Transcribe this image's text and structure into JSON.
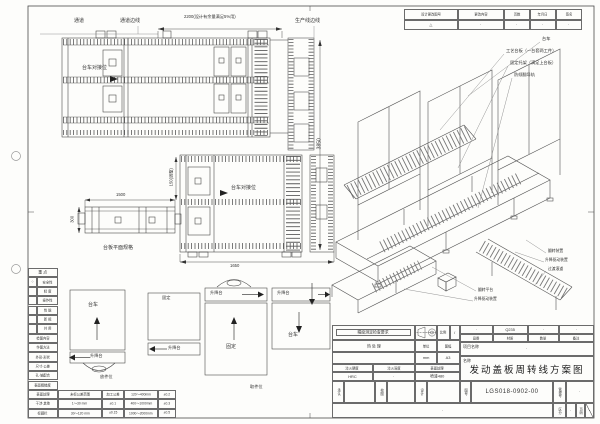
{
  "palette": {
    "ink": "#3a3a3a",
    "paper": "#fdfdfb",
    "grid": "#6b6b6b"
  },
  "revision": {
    "headers": [
      "设计更改图号",
      "更改内容",
      "页数",
      "年月日",
      "签名"
    ],
    "row": [
      "△",
      "·",
      "·",
      "·",
      "·"
    ]
  },
  "plan_top": {
    "passage": "通道",
    "passage_edge": "通道边线",
    "prod_edge": "生产线边线",
    "dock": "台车对接位",
    "dim_2200": "2200(设计有余量满足5%用)",
    "dim_3850": "3850"
  },
  "plan_mid": {
    "dock": "台车对接位",
    "dim_1650": "1650",
    "dim_150": "150(调整)"
  },
  "side_view": {
    "dim_1500": "1500",
    "dim_300": "300",
    "caption": "台板平面规格"
  },
  "stations": {
    "a_box": "台车",
    "a_strip": "升降台",
    "a_caption": "放件位",
    "b_box": "固定",
    "b_strip": "升降台",
    "c_box": "固定",
    "c_strip": "升降台",
    "d_box": "台车",
    "d_strip": "升降台",
    "d_caption": "取件位"
  },
  "checklist": {
    "section1": "重 点",
    "rows1": [
      {
        "mark": "○",
        "label": "安全性"
      },
      {
        "mark": "",
        "label": "精 度"
      },
      {
        "mark": "",
        "label": "操作性"
      },
      {
        "mark": "",
        "label": "性 能"
      },
      {
        "mark": "",
        "label": "新 规"
      },
      {
        "mark": "",
        "label": "共 用"
      }
    ],
    "section2": "检图内容",
    "rows2": [
      "作图方法",
      "外形·形状",
      "尺寸·公差",
      "孔·轴配合",
      "表面粗糙度",
      "表面处理",
      "干涉·其他",
      "标题栏"
    ]
  },
  "tolerance": {
    "rows": [
      [
        "未标公差范围",
        "加工公差",
        "120～400mm",
        "±0.2"
      ],
      [
        "1～30 mm",
        "±0.1",
        "400～1000mm",
        "±0.3"
      ],
      [
        "30～120 mm",
        "±0.15",
        "1000～2000mm",
        "±0.5"
      ]
    ]
  },
  "iso": {
    "callout_cart": "台车",
    "callout_pallet": "工艺台板（一台套两工件）",
    "callout_bracket": "固定托架（满足上台板）",
    "callout_rail": "防倾翻导轨",
    "callout_flip": "翻转装置",
    "callout_lift_drive": "升降驱动装置",
    "callout_transfer": "过渡滚道",
    "callout_flip_platform": "翻转平台",
    "callout_lift_drive2": "升降驱动装置"
  },
  "title_block": {
    "inspection": "精度测定检查要求",
    "scale_label": "比例",
    "scale_value": "/",
    "heat_label": "热 处 理",
    "unit_label": "单位",
    "unit_value": "mm",
    "sheet_label": "图幅",
    "sheet_value": "A3",
    "hardness_label": "淬火硬度",
    "hardness_value": "HRC",
    "depth_label": "淬火深度",
    "depth_value": "·",
    "surface_label": "表面处理",
    "surface_value": "喷漆480",
    "part_no_label": "品番",
    "part_no_value": "·",
    "material_label": "材质",
    "material_value": "Q235",
    "qty_label": "数量",
    "qty_value": "·",
    "remark_label": "备注",
    "remark_value": "·",
    "project_label": "项目名称",
    "project_value": "·",
    "name_label": "名称",
    "name_value": "发动盖板周转线方案图",
    "drawing_no_label": "图号",
    "drawing_no_value": "LGS018-0902-00",
    "mgmt_label": "管理号",
    "mgmt_value": "·",
    "approve_label": "承认",
    "check_label": "校图",
    "design_label": "设计",
    "stamp_note": "·",
    "class_label": "区分",
    "class_value": "·",
    "page_label": "页码"
  }
}
